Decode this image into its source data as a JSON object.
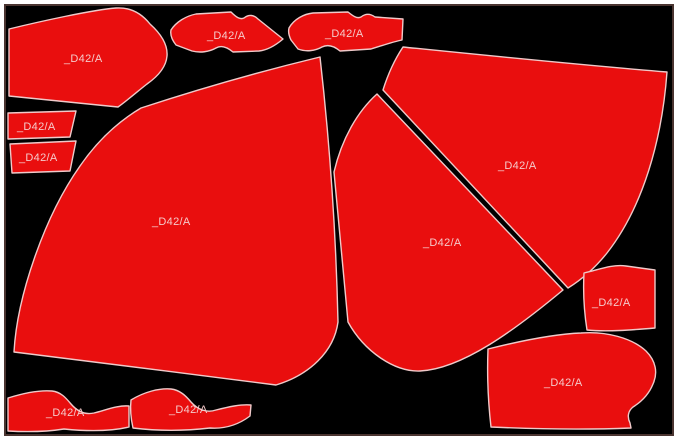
{
  "canvas": {
    "page_background": "#ffffff",
    "background": "#000000",
    "frame_color": "#4a3430"
  },
  "pieces": {
    "fill": "#e90e0e",
    "outline": "#efc9c9",
    "label_color": "#f5caca",
    "items": [
      {
        "name": "yoke-top-left",
        "label": "_D42/A"
      },
      {
        "name": "collar-top-a",
        "label": "_D42/A"
      },
      {
        "name": "collar-top-b",
        "label": "_D42/A"
      },
      {
        "name": "panel-right-large",
        "label": "_D42/A"
      },
      {
        "name": "rect-left-1",
        "label": "_D42/A"
      },
      {
        "name": "rect-left-2",
        "label": "_D42/A"
      },
      {
        "name": "fan-left-large",
        "label": "_D42/A"
      },
      {
        "name": "panel-middle",
        "label": "_D42/A"
      },
      {
        "name": "rect-right",
        "label": "_D42/A"
      },
      {
        "name": "yoke-bottom-right",
        "label": "_D42/A"
      },
      {
        "name": "collar-bottom-a",
        "label": "_D42/A"
      },
      {
        "name": "collar-bottom-b",
        "label": "_D42/A"
      }
    ]
  }
}
